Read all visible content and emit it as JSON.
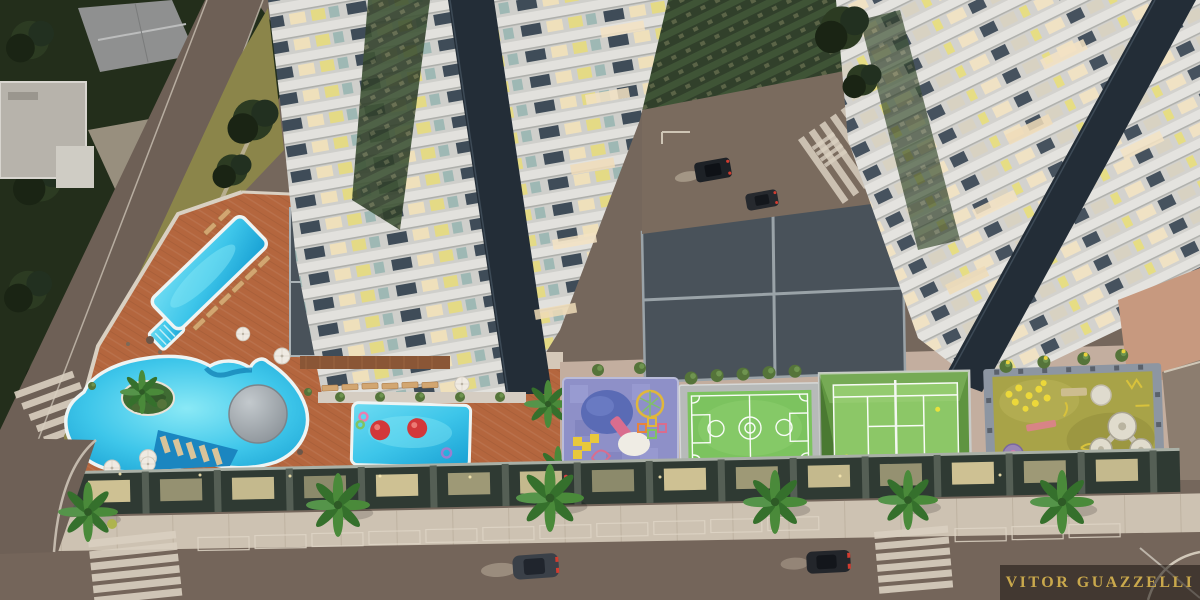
{
  "scene": {
    "watermark": "VITOR GUAZZELLI",
    "description": "Aerial dusk rendering of a residential condominium: two high-rise towers over a leisure podium deck with lap pool, leisure pool, kids pool, playground, multisport court, tennis court and play lawn, surrounded by streets with crosswalks, palms and cars"
  },
  "palette": {
    "street": "#75675c",
    "street_dark": "#6e6056",
    "sidewalk": "#cdc2b2",
    "deck_terracotta": "#b4663e",
    "pavement_light": "#c3ae9f",
    "pool_water": "#3ec6ea",
    "pool_deep": "#179fd3",
    "pool_coping": "#eef4f3",
    "roof_dark": "#49525a",
    "roof_beam": "#9aa3a8",
    "tower_band": "#dcdbd7",
    "tower_facade": "#cfcfcb",
    "tower_spine": "#232d37",
    "glass_green": "#3c5136",
    "window_warm": "#efe0bb",
    "window_dark": "#3f4c58",
    "court_green": "#7cc35f",
    "tennis_green": "#8cc767",
    "lawn_olive": "#a8a348",
    "playground_purple": "#8e90c8",
    "tree_dark": "#222d1a",
    "palm_green": "#4a8a3a",
    "watermark_gold": "#c9a84c",
    "watermark_bar": "rgba(25,20,16,0.55)",
    "car_body": "#2a2e34",
    "accent_red": "#d2383a"
  }
}
